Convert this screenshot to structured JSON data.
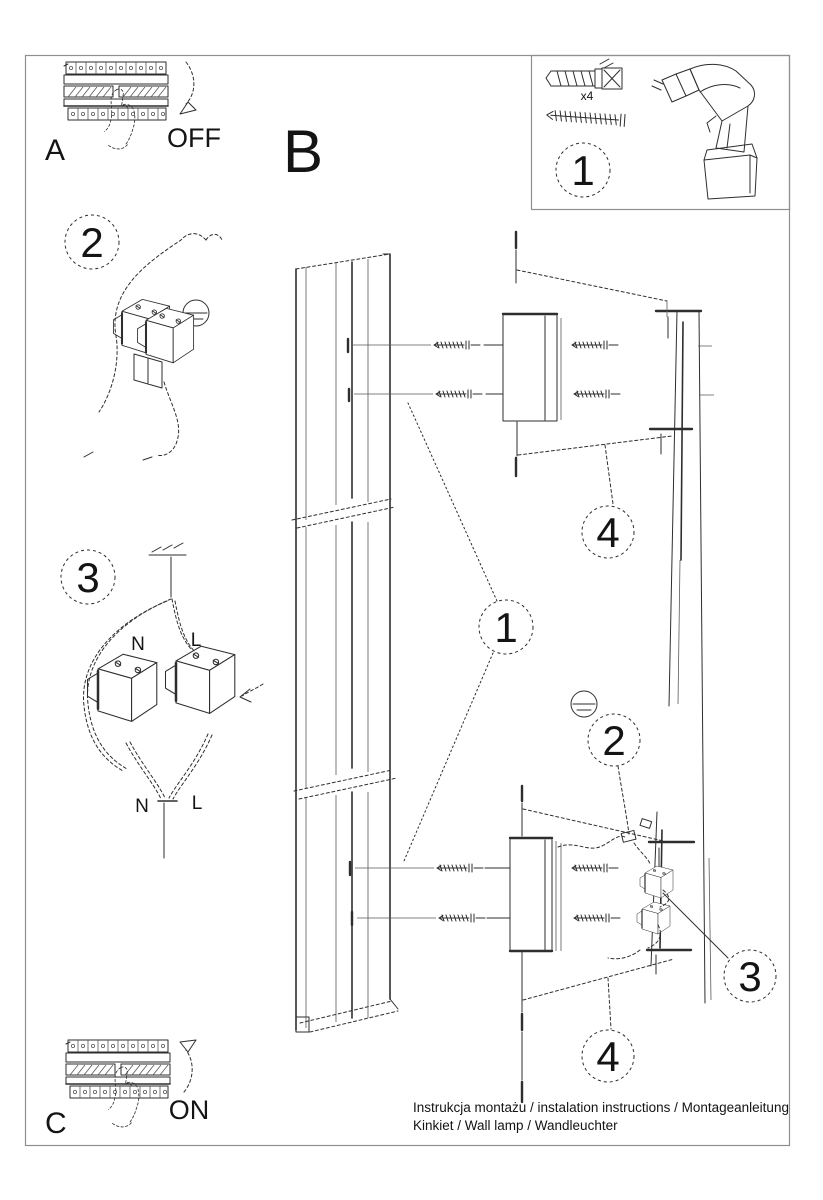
{
  "document": {
    "footer": {
      "line1": "Instrukcja montażu / instalation instructions / Montageanleitung",
      "line2": "Kinkiet / Wall lamp / Wandleuchter"
    }
  },
  "sections": {
    "a": {
      "label": "A",
      "breaker_state": "OFF"
    },
    "b": {
      "label": "B"
    },
    "c": {
      "label": "C",
      "breaker_state": "ON"
    }
  },
  "kit_box": {
    "step": "1",
    "screw_quantity": "x4"
  },
  "detail_steps": {
    "wiring_connector": "2",
    "wiring_terminals": "3"
  },
  "callouts": {
    "c1": "1",
    "c2": "2",
    "c3": "3",
    "c4": "4"
  },
  "wiring_labels": {
    "neutral_top": "N",
    "live_top": "L",
    "neutral_bottom": "N",
    "live_bottom": "L"
  },
  "colors": {
    "line": "#2e2e2e",
    "frame": "#8f8f8f",
    "background": "#ffffff",
    "text": "#141414"
  }
}
